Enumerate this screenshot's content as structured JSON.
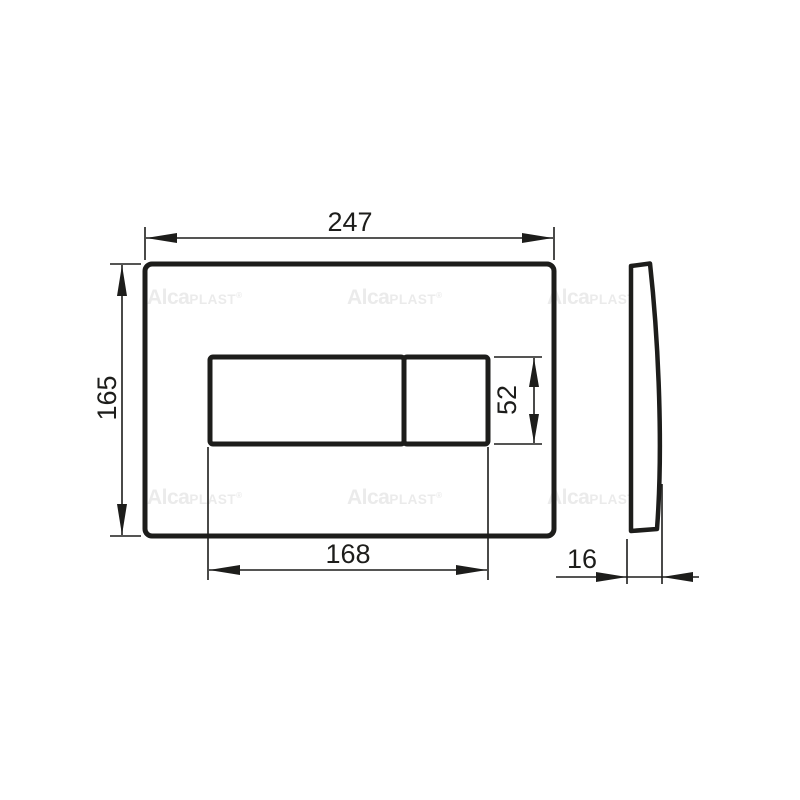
{
  "drawing": {
    "dimensions": {
      "overall_width": "247",
      "overall_height": "165",
      "button_area_width": "168",
      "button_height": "52",
      "depth": "16"
    },
    "watermark": {
      "bold": "Alca",
      "light": "PLAST",
      "registered": "®"
    },
    "colors": {
      "line": "#1d1d1b",
      "watermark": "#ebebeb",
      "background": "#ffffff"
    }
  }
}
